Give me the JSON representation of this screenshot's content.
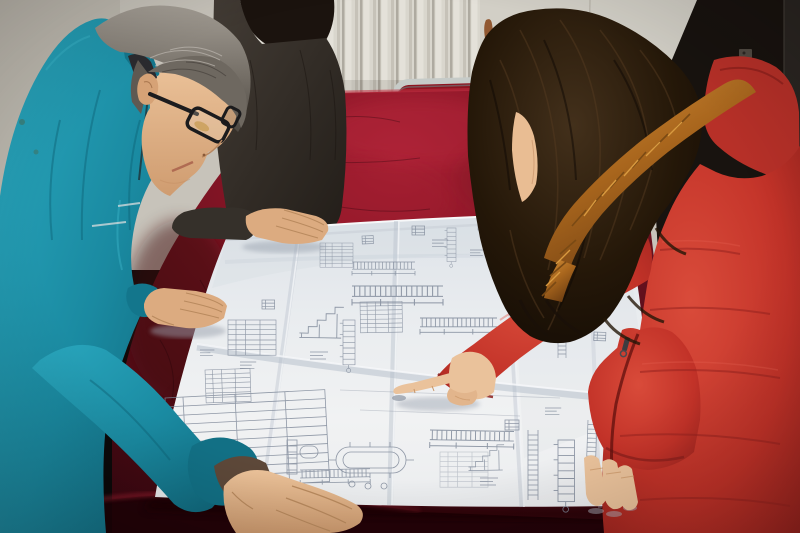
{
  "meta": {
    "title": "Workers reviewing a blueprint",
    "description": "Two colleagues lean over a large folded engineering blueprint spread on a dark red velvet-covered table: a gray-haired man in a teal work jacket and black glasses studies the drawings, a partially hidden colleague in a charcoal jacket rests a hand on the sheet, and a woman in a red quilted parka with an orange fur-trimmed hood points at a detail with her index finger.",
    "width": 800,
    "height": 533
  },
  "people": [
    {
      "id": "worker-left",
      "description": "Middle-aged man, gray hair, black rectangular glasses, teal work jacket, both hands resting on the blueprint"
    },
    {
      "id": "colleague-behind",
      "description": "Colleague in dark charcoal jacket standing behind, black hair, right hand resting on the top edge of the blueprint"
    },
    {
      "id": "worker-right",
      "description": "Woman with long dark wavy hair, red quilted parka with orange fur-trimmed hood, pointing at the blueprint with her right index finger, left fingers resting on the sheet"
    }
  ],
  "objects": [
    {
      "id": "blueprint",
      "description": "Large folded white engineering drawing sheet with structural section details, schedules, dimension strings and an oval tank plan; fold creases visible"
    },
    {
      "id": "table",
      "description": "Large table draped in crimson crushed velvet, brightly lit at the back, deep maroon in front"
    },
    {
      "id": "radiator",
      "description": "White wall radiator with vertical fins behind the table"
    },
    {
      "id": "chair",
      "description": "Metal-framed chair with red upholstered back behind the table"
    },
    {
      "id": "wall-and-door",
      "description": "Pale scuffed wall panel with a small rust stain; dark door with latch on the right"
    }
  ],
  "palette": {
    "wall": "#c7c3ba",
    "palePanel": "#d2cfc6",
    "darkDoor": "#18130f",
    "chairRed": "#8d1520",
    "velvetLit": "#a82134",
    "velvetDark": "#2f050d",
    "paper": "#eef0f2",
    "ink": "#7d8798",
    "tealJacket": "#1a8aa1",
    "darkJacket": "#35302a",
    "hairGray": "#8f8981",
    "hairBrown": "#2a1c10",
    "furOrange": "#b06a1f",
    "coatRed": "#c93228",
    "hoodRed": "#b73028",
    "skinMan": "#dcab80",
    "skinWoman": "#eac29b",
    "rustStain": "#8a4a20"
  }
}
